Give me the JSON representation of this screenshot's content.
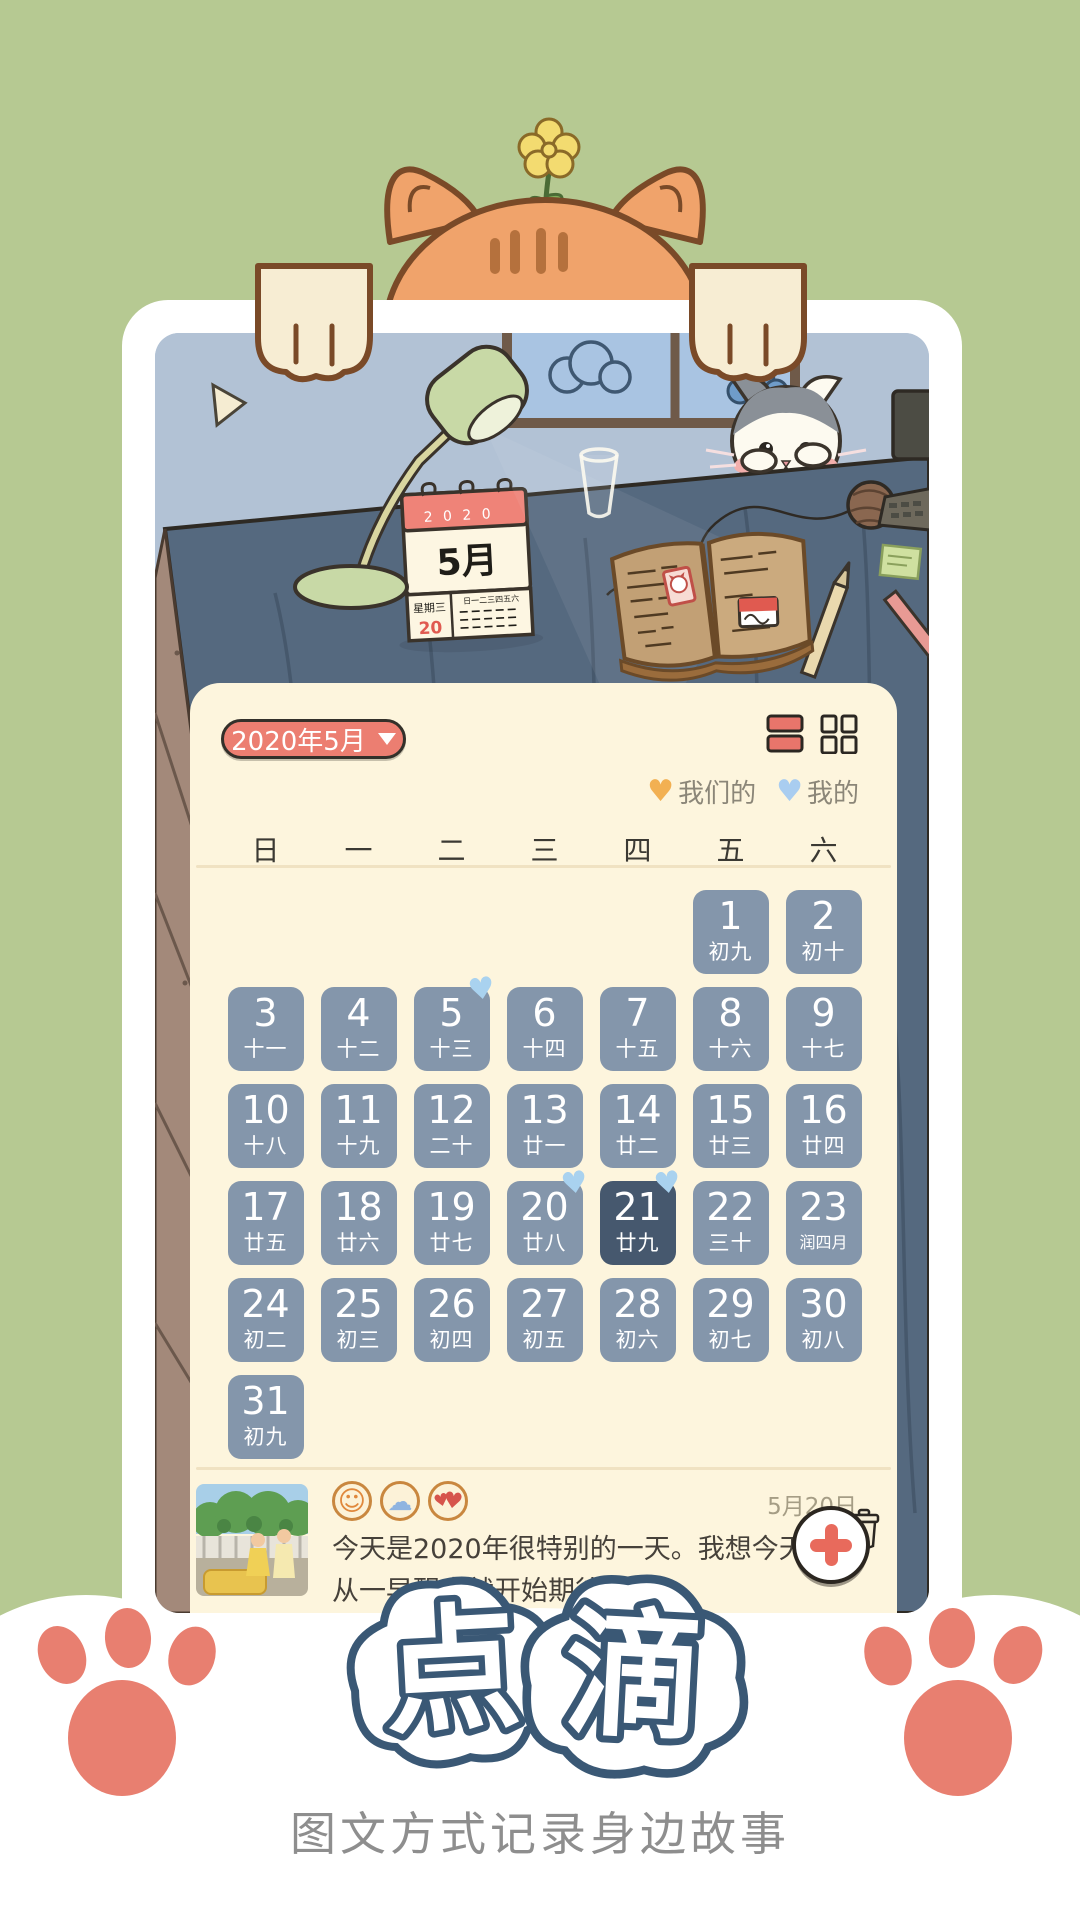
{
  "app": {
    "logo_chars": [
      "点",
      "滴"
    ],
    "tagline": "图文方式记录身边故事"
  },
  "scene": {
    "desk_calendar": {
      "year": "2 0 2 0",
      "month": "5月",
      "weekday": "星期三",
      "day": "20",
      "mini_week": "日一二三四五六"
    }
  },
  "panel": {
    "month_selector": "2020年5月",
    "legend": [
      {
        "label": "我们的",
        "color": "#f2b052"
      },
      {
        "label": "我的",
        "color": "#a9cdf0"
      }
    ],
    "weekdays": [
      "日",
      "一",
      "二",
      "三",
      "四",
      "五",
      "六"
    ],
    "first_day_col": 5,
    "days": [
      {
        "d": "1",
        "lunar": "初九"
      },
      {
        "d": "2",
        "lunar": "初十"
      },
      {
        "d": "3",
        "lunar": "十一"
      },
      {
        "d": "4",
        "lunar": "十二"
      },
      {
        "d": "5",
        "lunar": "十三",
        "heart": true
      },
      {
        "d": "6",
        "lunar": "十四"
      },
      {
        "d": "7",
        "lunar": "十五"
      },
      {
        "d": "8",
        "lunar": "十六"
      },
      {
        "d": "9",
        "lunar": "十七"
      },
      {
        "d": "10",
        "lunar": "十八"
      },
      {
        "d": "11",
        "lunar": "十九"
      },
      {
        "d": "12",
        "lunar": "二十"
      },
      {
        "d": "13",
        "lunar": "廿一"
      },
      {
        "d": "14",
        "lunar": "廿二"
      },
      {
        "d": "15",
        "lunar": "廿三"
      },
      {
        "d": "16",
        "lunar": "廿四"
      },
      {
        "d": "17",
        "lunar": "廿五"
      },
      {
        "d": "18",
        "lunar": "廿六"
      },
      {
        "d": "19",
        "lunar": "廿七"
      },
      {
        "d": "20",
        "lunar": "廿八",
        "heart": true
      },
      {
        "d": "21",
        "lunar": "廿九",
        "heart": true,
        "selected": true
      },
      {
        "d": "22",
        "lunar": "三十"
      },
      {
        "d": "23",
        "lunar": "润四月"
      },
      {
        "d": "24",
        "lunar": "初二"
      },
      {
        "d": "25",
        "lunar": "初三"
      },
      {
        "d": "26",
        "lunar": "初四"
      },
      {
        "d": "27",
        "lunar": "初五"
      },
      {
        "d": "28",
        "lunar": "初六"
      },
      {
        "d": "29",
        "lunar": "初七"
      },
      {
        "d": "30",
        "lunar": "初八"
      },
      {
        "d": "31",
        "lunar": "初九"
      }
    ]
  },
  "entry": {
    "date": "5月20日",
    "line1": "今天是2020年很特别的一天。我想今天很多",
    "line2": "从一早醒来就开始期待..",
    "stickers": [
      "smiley-face",
      "cloud",
      "double-heart"
    ]
  },
  "fab": {
    "label": "+"
  },
  "colors": {
    "background": "#b6c992",
    "card": "#ffffff",
    "panel": "#fdf5dd",
    "accent": "#ec7e71",
    "day_cell": "#8496ab",
    "day_selected": "#46586e",
    "heart_blue": "#a9d2ef",
    "legend_orange": "#f2b052",
    "legend_blue": "#a9cdf0",
    "logo_blue": "#3a5875",
    "paw_coral": "#e87f70"
  }
}
